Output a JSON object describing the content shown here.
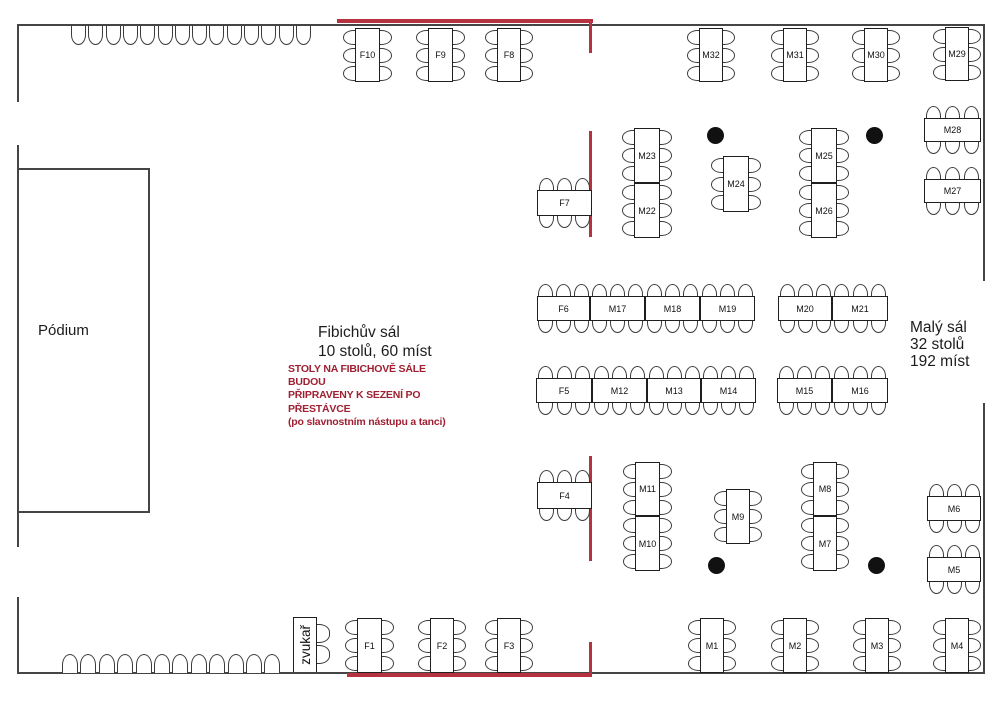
{
  "podium": {
    "label": "Pódium"
  },
  "sound_engineer": {
    "label": "zvukař"
  },
  "halls": {
    "fibich": {
      "label": "Fibichův sál\n10 stolů, 60 míst"
    },
    "maly": {
      "label": "Malý sál\n32 stolů\n192 míst"
    }
  },
  "note": {
    "text": "STOLY NA FIBICHOVĚ SÁLE BUDOU\nPŘIPRAVENY K SEZENÍ PO\nPŘESTÁVCE\n(po slavnostním nástupu a tanci)"
  },
  "colors": {
    "partition_red": "#b5333f",
    "note_red": "#9e2032",
    "wall": "#454545",
    "table_border": "#1f1f1f",
    "chair": "#3c3c3c",
    "pillar": "#111111"
  },
  "tables": [
    {
      "label": "F1",
      "x": 357,
      "y": 618,
      "w": 25,
      "h": 55,
      "o": "v"
    },
    {
      "label": "F2",
      "x": 430,
      "y": 618,
      "w": 24,
      "h": 55,
      "o": "v"
    },
    {
      "label": "F3",
      "x": 497,
      "y": 618,
      "w": 24,
      "h": 55,
      "o": "v"
    },
    {
      "label": "F4",
      "x": 537,
      "y": 482,
      "w": 55,
      "h": 27,
      "o": "h"
    },
    {
      "label": "F5",
      "x": 536,
      "y": 378,
      "w": 56,
      "h": 25,
      "o": "h"
    },
    {
      "label": "F6",
      "x": 537,
      "y": 296,
      "w": 53,
      "h": 25,
      "o": "h"
    },
    {
      "label": "F7",
      "x": 537,
      "y": 190,
      "w": 55,
      "h": 26,
      "o": "h"
    },
    {
      "label": "F8",
      "x": 497,
      "y": 28,
      "w": 24,
      "h": 54,
      "o": "v"
    },
    {
      "label": "F9",
      "x": 428,
      "y": 28,
      "w": 25,
      "h": 54,
      "o": "v"
    },
    {
      "label": "F10",
      "x": 355,
      "y": 28,
      "w": 25,
      "h": 54,
      "o": "v"
    },
    {
      "label": "M1",
      "x": 700,
      "y": 618,
      "w": 24,
      "h": 55,
      "o": "v"
    },
    {
      "label": "M2",
      "x": 783,
      "y": 618,
      "w": 24,
      "h": 55,
      "o": "v"
    },
    {
      "label": "M3",
      "x": 865,
      "y": 618,
      "w": 24,
      "h": 55,
      "o": "v"
    },
    {
      "label": "M4",
      "x": 945,
      "y": 618,
      "w": 24,
      "h": 55,
      "o": "v"
    },
    {
      "label": "M5",
      "x": 927,
      "y": 557,
      "w": 54,
      "h": 25,
      "o": "h"
    },
    {
      "label": "M6",
      "x": 927,
      "y": 496,
      "w": 54,
      "h": 25,
      "o": "h"
    },
    {
      "label": "M7",
      "x": 813,
      "y": 516,
      "w": 24,
      "h": 55,
      "o": "v"
    },
    {
      "label": "M8",
      "x": 813,
      "y": 462,
      "w": 24,
      "h": 54,
      "o": "v"
    },
    {
      "label": "M9",
      "x": 726,
      "y": 489,
      "w": 24,
      "h": 55,
      "o": "v"
    },
    {
      "label": "M10",
      "x": 635,
      "y": 516,
      "w": 25,
      "h": 55,
      "o": "v"
    },
    {
      "label": "M11",
      "x": 635,
      "y": 462,
      "w": 25,
      "h": 54,
      "o": "v"
    },
    {
      "label": "M12",
      "x": 592,
      "y": 378,
      "w": 55,
      "h": 25,
      "o": "h"
    },
    {
      "label": "M13",
      "x": 647,
      "y": 378,
      "w": 54,
      "h": 25,
      "o": "h"
    },
    {
      "label": "M14",
      "x": 701,
      "y": 378,
      "w": 55,
      "h": 25,
      "o": "h"
    },
    {
      "label": "M15",
      "x": 777,
      "y": 378,
      "w": 55,
      "h": 25,
      "o": "h"
    },
    {
      "label": "M16",
      "x": 832,
      "y": 378,
      "w": 56,
      "h": 25,
      "o": "h"
    },
    {
      "label": "M17",
      "x": 590,
      "y": 296,
      "w": 55,
      "h": 25,
      "o": "h"
    },
    {
      "label": "M18",
      "x": 645,
      "y": 296,
      "w": 55,
      "h": 25,
      "o": "h"
    },
    {
      "label": "M19",
      "x": 700,
      "y": 296,
      "w": 55,
      "h": 25,
      "o": "h"
    },
    {
      "label": "M20",
      "x": 778,
      "y": 296,
      "w": 54,
      "h": 25,
      "o": "h"
    },
    {
      "label": "M21",
      "x": 832,
      "y": 296,
      "w": 56,
      "h": 25,
      "o": "h"
    },
    {
      "label": "M22",
      "x": 634,
      "y": 183,
      "w": 26,
      "h": 55,
      "o": "v"
    },
    {
      "label": "M23",
      "x": 634,
      "y": 128,
      "w": 26,
      "h": 55,
      "o": "v"
    },
    {
      "label": "M24",
      "x": 723,
      "y": 156,
      "w": 26,
      "h": 56,
      "o": "v"
    },
    {
      "label": "M25",
      "x": 811,
      "y": 128,
      "w": 26,
      "h": 55,
      "o": "v"
    },
    {
      "label": "M26",
      "x": 811,
      "y": 183,
      "w": 26,
      "h": 55,
      "o": "v"
    },
    {
      "label": "M27",
      "x": 924,
      "y": 179,
      "w": 57,
      "h": 24,
      "o": "h"
    },
    {
      "label": "M28",
      "x": 924,
      "y": 118,
      "w": 57,
      "h": 24,
      "o": "h"
    },
    {
      "label": "M29",
      "x": 945,
      "y": 27,
      "w": 24,
      "h": 54,
      "o": "v"
    },
    {
      "label": "M30",
      "x": 864,
      "y": 28,
      "w": 24,
      "h": 54,
      "o": "v"
    },
    {
      "label": "M31",
      "x": 783,
      "y": 28,
      "w": 24,
      "h": 54,
      "o": "v"
    },
    {
      "label": "M32",
      "x": 699,
      "y": 28,
      "w": 24,
      "h": 54,
      "o": "v"
    }
  ],
  "walls": [
    [
      17,
      24,
      967,
      2
    ],
    [
      17,
      24,
      2,
      78
    ],
    [
      17,
      145,
      2,
      402
    ],
    [
      17,
      597,
      2,
      77
    ],
    [
      17,
      672,
      967,
      2
    ],
    [
      983,
      24,
      2,
      257
    ],
    [
      983,
      403,
      2,
      271
    ]
  ],
  "partitions": [
    [
      337,
      19,
      256,
      4
    ],
    [
      589,
      19,
      3,
      34
    ],
    [
      589,
      131,
      3,
      106
    ],
    [
      589,
      456,
      3,
      105
    ],
    [
      589,
      642,
      3,
      35
    ],
    [
      347,
      673,
      245,
      4
    ]
  ],
  "pillars": [
    [
      715,
      135
    ],
    [
      874,
      135
    ],
    [
      716,
      565
    ],
    [
      876,
      565
    ]
  ],
  "wall_chairs": {
    "top": {
      "count": 14,
      "x0": 71,
      "pitch": 17.3,
      "y": 26,
      "w": 15,
      "h": 19,
      "open": "open-t"
    },
    "bottom": {
      "count": 12,
      "x0": 62,
      "pitch": 18.4,
      "y": 654,
      "w": 16,
      "h": 19,
      "open": "open-b"
    }
  }
}
